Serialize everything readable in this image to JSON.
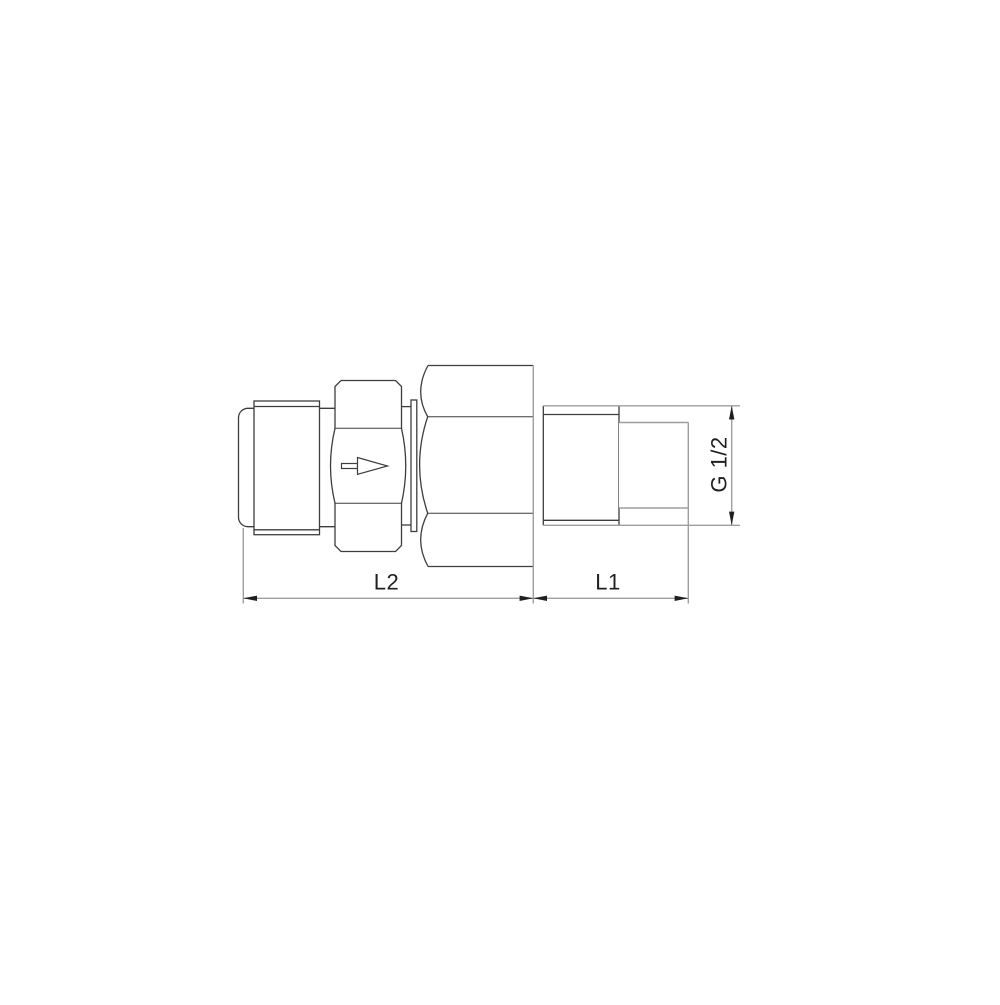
{
  "page": {
    "background": "#ffffff"
  },
  "drawing": {
    "kind": "technical line drawing",
    "subject": "inline check valve with union nut and male threaded connections, side view",
    "flow_arrow_direction": "right",
    "labels": {
      "l2": "L2",
      "l1": "L1",
      "thread": "G 1/2"
    },
    "colors": {
      "object_line": "#3d3d3d",
      "dimension_line": "#9e9e9e",
      "arrowhead": "#1f1f1f",
      "text": "#1f1f1f"
    }
  }
}
